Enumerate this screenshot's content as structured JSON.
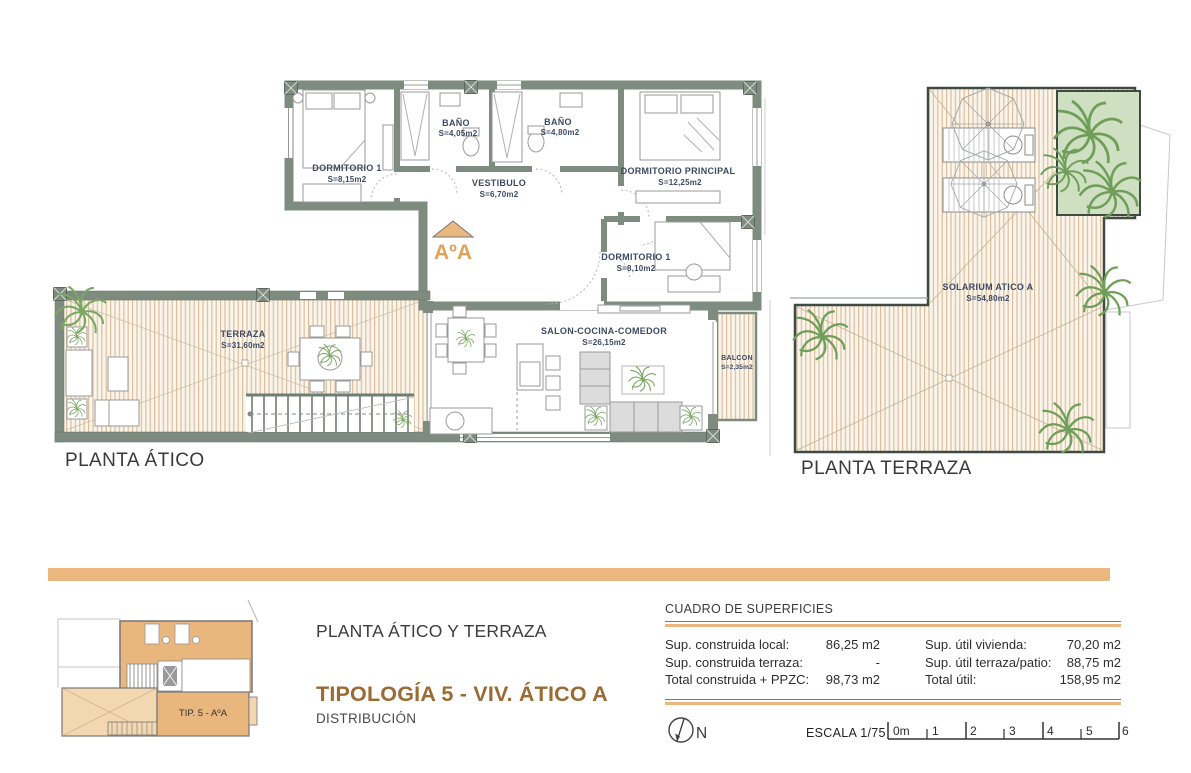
{
  "colors": {
    "wall": "#7e8c80",
    "accent_orange": "#eab87e",
    "title_brown": "#9a6b33",
    "room_label_navy": "#3c4a63",
    "deck_stripe": "#d9c0a0",
    "garden_green": "#cfe0c2",
    "plant_green": "#7ca763"
  },
  "plans": {
    "atico": {
      "caption": "PLANTA ÁTICO",
      "section_marker": "AºA",
      "rooms": [
        {
          "name": "DORMITORIO 1",
          "area": "S=8,15m2"
        },
        {
          "name": "BAÑO",
          "area": "S=4,05m2"
        },
        {
          "name": "BAÑO",
          "area": "S=4,80m2"
        },
        {
          "name": "DORMITORIO PRINCIPAL",
          "area": "S=12,25m2"
        },
        {
          "name": "VESTIBULO",
          "area": "S=6,70m2"
        },
        {
          "name": "DORMITORIO 1",
          "area": "S=8,10m2"
        },
        {
          "name": "TERRAZA",
          "area": "S=31,60m2"
        },
        {
          "name": "SALON-COCINA-COMEDOR",
          "area": "S=26,15m2"
        },
        {
          "name": "BALCON",
          "area": "S=2,35m2"
        }
      ]
    },
    "terraza": {
      "caption": "PLANTA TERRAZA",
      "rooms": [
        {
          "name": "SOLARIUM ATICO A",
          "area": "S=54,80m2"
        }
      ]
    }
  },
  "footer": {
    "thumbnail_label": "TIP. 5 - AºA",
    "plan_title": "PLANTA ÁTICO Y TERRAZA",
    "typology_title": "TIPOLOGÍA 5 - VIV. ÁTICO A",
    "typology_subtitle": "DISTRIBUCIÓN",
    "surfaces": {
      "heading": "CUADRO DE SUPERFICIES",
      "left_rows": [
        {
          "label": "Sup. construida local:",
          "value": "86,25 m2"
        },
        {
          "label": "Sup. construida terraza:",
          "value": "-"
        },
        {
          "label": "Total construida + PPZC:",
          "value": "98,73 m2"
        }
      ],
      "right_rows": [
        {
          "label": "Sup. útil vivienda:",
          "value": "70,20 m2"
        },
        {
          "label": "Sup. útil terraza/patio:",
          "value": "88,75 m2"
        },
        {
          "label": "Total útil:",
          "value": "158,95 m2"
        }
      ]
    },
    "north_label": "N",
    "scale_label": "ESCALA 1/75",
    "scale_ticks": [
      "0m",
      "1",
      "2",
      "3",
      "4",
      "5",
      "6"
    ]
  }
}
